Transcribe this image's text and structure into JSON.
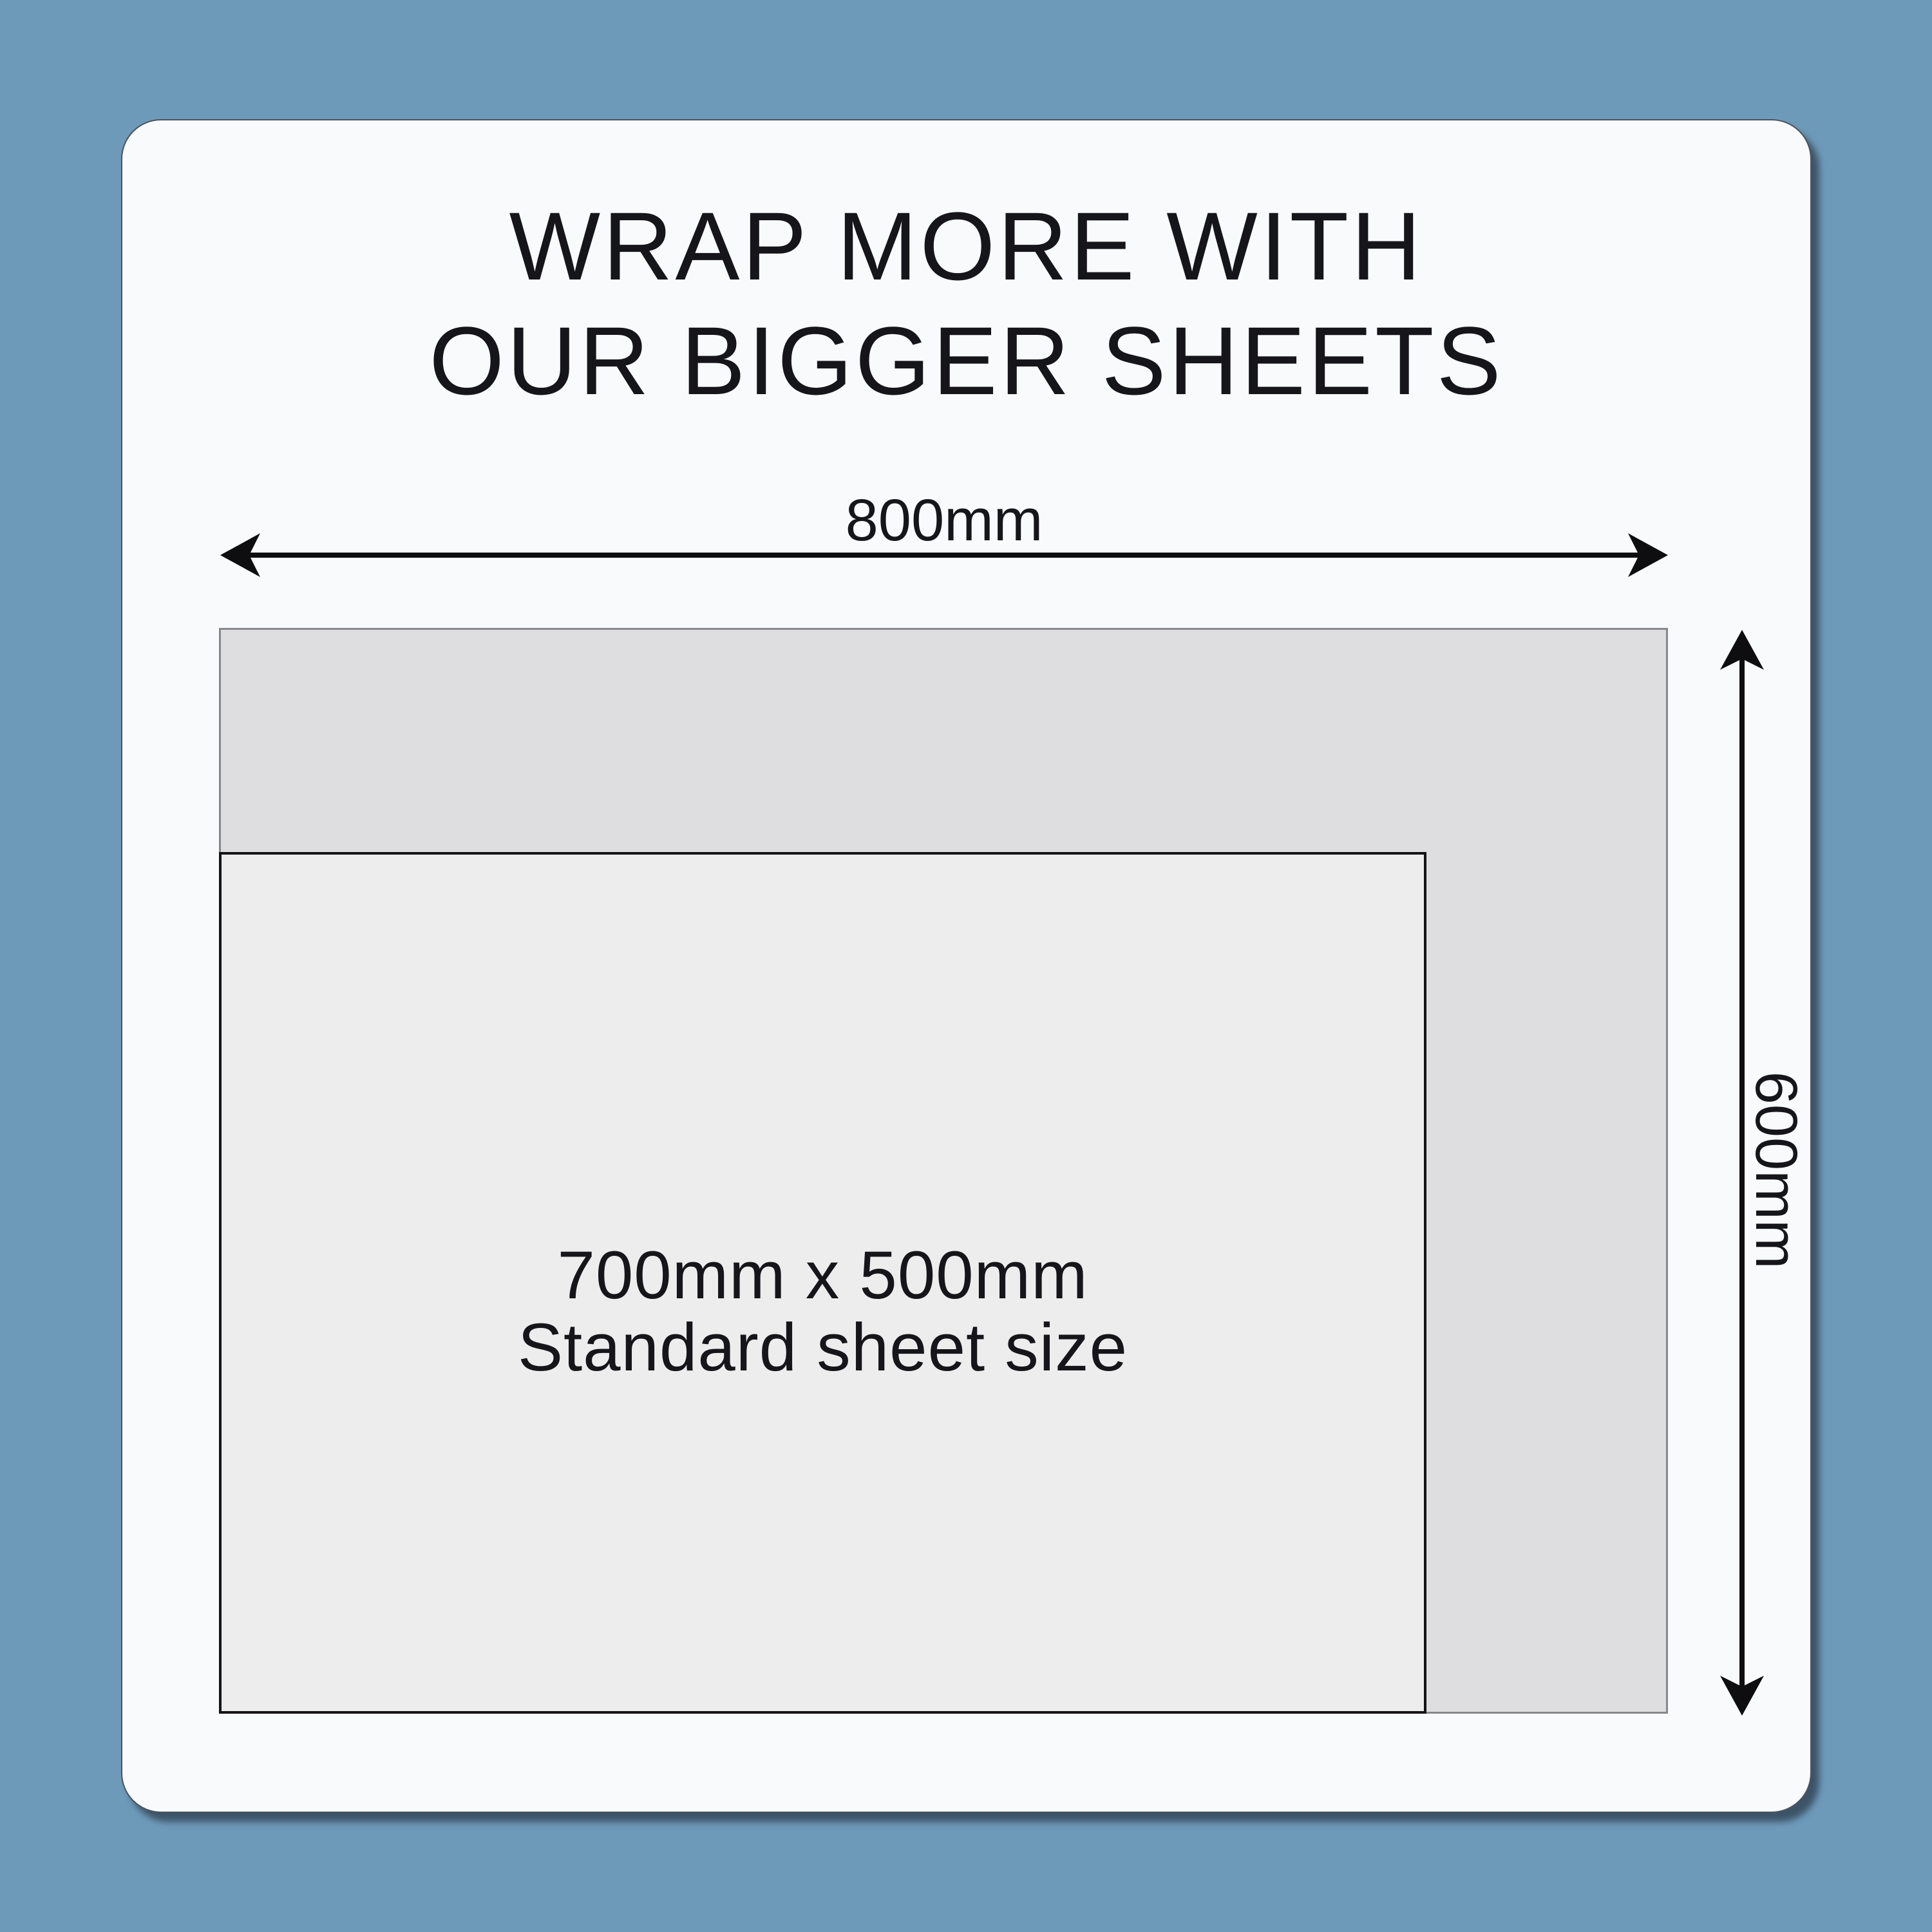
{
  "title": {
    "line1": "WRAP MORE WITH",
    "line2": "OUR BIGGER SHEETS"
  },
  "width_dimension": {
    "label": "800mm"
  },
  "height_dimension": {
    "label": "600mm"
  },
  "standard_sheet": {
    "line1": "700mm x 500mm",
    "line2": "Standard sheet size"
  },
  "colors": {
    "background": "#6e9aba",
    "card": "#f8fafb",
    "big_sheet_fill": "#dedee0",
    "big_sheet_border": "#87878c",
    "standard_sheet_fill": "#ededee",
    "standard_sheet_border": "#141417",
    "text": "#16161a",
    "arrow": "#0e0e10"
  }
}
